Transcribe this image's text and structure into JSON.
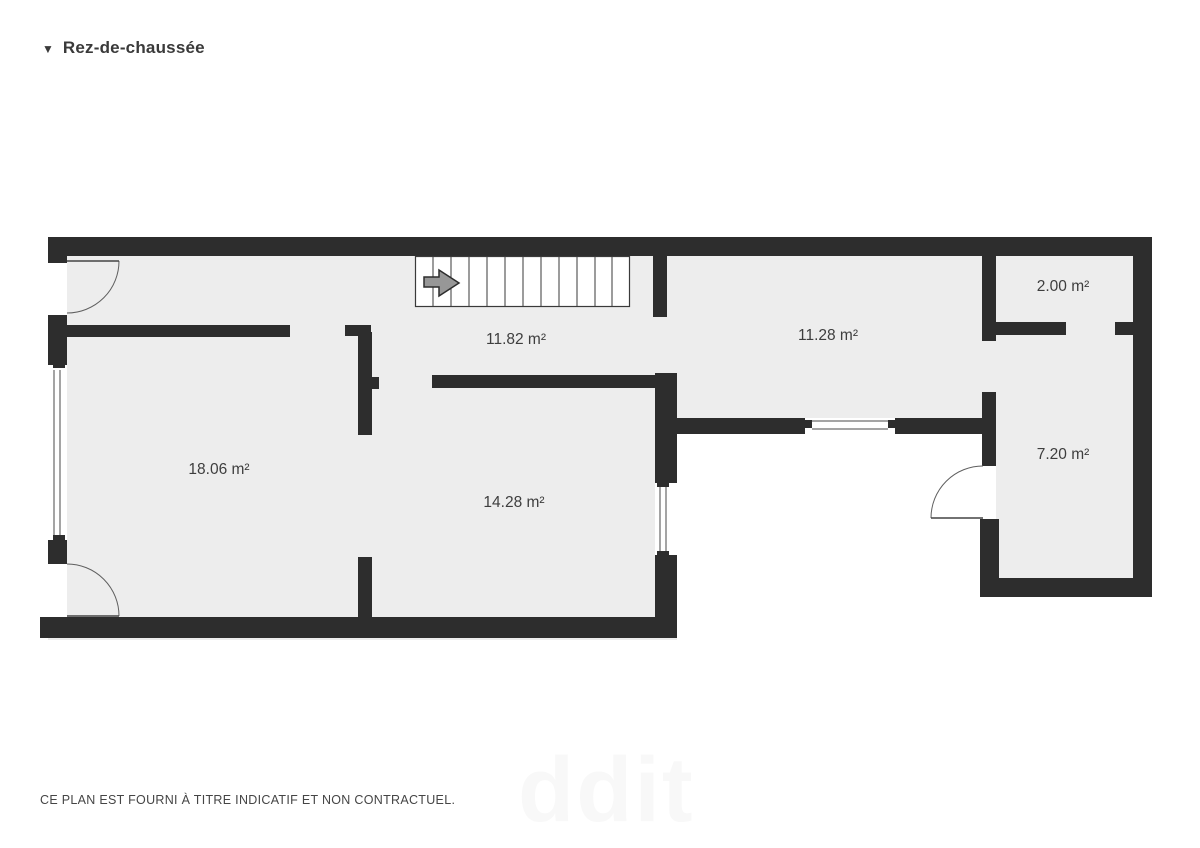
{
  "header": {
    "collapse_icon": "▼",
    "title": "Rez-de-chaussée"
  },
  "footer": {
    "disclaimer": "CE PLAN EST FOURNI À TITRE INDICATIF ET NON CONTRACTUEL.",
    "watermark": "ddit"
  },
  "colors": {
    "wall": "#2d2d2d",
    "floor": "#ededed",
    "window_line": "#4a4a4a",
    "door_line": "#5f5f5f",
    "stair_line": "#3a3a3a",
    "stair_box_fill": "#ffffff",
    "arrow_fill": "#979797",
    "arrow_stroke": "#2d2d2d"
  },
  "floorplan": {
    "floors": [
      {
        "x": 48,
        "y": 237,
        "w": 629,
        "h": 403
      },
      {
        "x": 653,
        "y": 237,
        "w": 346,
        "h": 196
      },
      {
        "x": 982,
        "y": 237,
        "w": 170,
        "h": 360
      }
    ],
    "walls": [
      {
        "x": 48,
        "y": 237,
        "w": 1102,
        "h": 19
      },
      {
        "x": 48,
        "y": 237,
        "w": 19,
        "h": 26
      },
      {
        "x": 48,
        "y": 315,
        "w": 19,
        "h": 50
      },
      {
        "x": 48,
        "y": 540,
        "w": 19,
        "h": 24
      },
      {
        "x": 40,
        "y": 617,
        "w": 637,
        "h": 21
      },
      {
        "x": 67,
        "y": 325,
        "w": 223,
        "h": 12
      },
      {
        "x": 345,
        "y": 325,
        "w": 26,
        "h": 11
      },
      {
        "x": 358,
        "y": 332,
        "w": 14,
        "h": 103
      },
      {
        "x": 370,
        "y": 377,
        "w": 9,
        "h": 12
      },
      {
        "x": 432,
        "y": 375,
        "w": 225,
        "h": 13
      },
      {
        "x": 358,
        "y": 557,
        "w": 14,
        "h": 65
      },
      {
        "x": 653,
        "y": 256,
        "w": 14,
        "h": 61
      },
      {
        "x": 655,
        "y": 373,
        "w": 22,
        "h": 110
      },
      {
        "x": 655,
        "y": 555,
        "w": 22,
        "h": 83
      },
      {
        "x": 672,
        "y": 418,
        "w": 133,
        "h": 16
      },
      {
        "x": 895,
        "y": 418,
        "w": 95,
        "h": 16
      },
      {
        "x": 982,
        "y": 248,
        "w": 14,
        "h": 93
      },
      {
        "x": 982,
        "y": 392,
        "w": 14,
        "h": 74
      },
      {
        "x": 980,
        "y": 519,
        "w": 19,
        "h": 78
      },
      {
        "x": 980,
        "y": 578,
        "w": 172,
        "h": 19
      },
      {
        "x": 1133,
        "y": 237,
        "w": 19,
        "h": 360
      },
      {
        "x": 996,
        "y": 322,
        "w": 70,
        "h": 13
      },
      {
        "x": 1115,
        "y": 322,
        "w": 18,
        "h": 13
      }
    ],
    "door_openings": [
      {
        "x": 48,
        "y": 263,
        "w": 19,
        "h": 52
      },
      {
        "x": 48,
        "y": 564,
        "w": 19,
        "h": 53
      },
      {
        "x": 980,
        "y": 466,
        "w": 16,
        "h": 53
      }
    ],
    "windows": [
      {
        "rect": {
          "x": 48,
          "y": 365,
          "w": 19,
          "h": 175
        },
        "lines": [
          {
            "x1": 54,
            "y1": 370,
            "x2": 54,
            "y2": 535
          },
          {
            "x1": 60,
            "y1": 370,
            "x2": 60,
            "y2": 535
          }
        ],
        "caps": [
          {
            "x": 53,
            "y": 363,
            "w": 12,
            "h": 5
          },
          {
            "x": 53,
            "y": 535,
            "w": 12,
            "h": 5
          }
        ]
      },
      {
        "rect": {
          "x": 655,
          "y": 483,
          "w": 22,
          "h": 72
        },
        "lines": [
          {
            "x1": 660,
            "y1": 485,
            "x2": 660,
            "y2": 553
          },
          {
            "x1": 666,
            "y1": 485,
            "x2": 666,
            "y2": 553
          }
        ],
        "caps": [
          {
            "x": 657,
            "y": 483,
            "w": 12,
            "h": 4
          },
          {
            "x": 657,
            "y": 551,
            "w": 12,
            "h": 4
          }
        ]
      },
      {
        "rect": {
          "x": 805,
          "y": 418,
          "w": 90,
          "h": 16
        },
        "lines": [
          {
            "x1": 812,
            "y1": 421,
            "x2": 888,
            "y2": 421
          },
          {
            "x1": 812,
            "y1": 429,
            "x2": 888,
            "y2": 429
          }
        ],
        "caps": [
          {
            "x": 805,
            "y": 420,
            "w": 7,
            "h": 8
          },
          {
            "x": 888,
            "y": 420,
            "w": 7,
            "h": 8
          }
        ]
      }
    ],
    "doors": [
      {
        "leaf": {
          "x1": 67,
          "y1": 261,
          "x2": 119,
          "y2": 261
        },
        "arc": "M 119 261 A 52 52 0 0 1 67 313"
      },
      {
        "leaf": {
          "x1": 67,
          "y1": 616,
          "x2": 119,
          "y2": 616
        },
        "arc": "M 67 564 A 52 52 0 0 1 119 616"
      },
      {
        "leaf": {
          "x1": 931,
          "y1": 518,
          "x2": 983,
          "y2": 518
        },
        "arc": "M 983 466 A 52 52 0 0 0 931 518"
      }
    ],
    "stairs": {
      "box": {
        "x": 415,
        "y": 256,
        "w": 215,
        "h": 51
      },
      "tread_xs": [
        433,
        451,
        469,
        487,
        505,
        523,
        541,
        559,
        577,
        595,
        612
      ],
      "tread_y1": 257,
      "tread_y2": 306,
      "arrow_points": "424,277 439,277 439,270 459,283 439,296 439,287 424,287"
    },
    "rooms": [
      {
        "label": "18.06 m²",
        "cx": 219,
        "cy": 470
      },
      {
        "label": "14.28 m²",
        "cx": 514,
        "cy": 503
      },
      {
        "label": "11.82 m²",
        "cx": 516,
        "cy": 340
      },
      {
        "label": "11.28 m²",
        "cx": 828,
        "cy": 336
      },
      {
        "label": "2.00 m²",
        "cx": 1063,
        "cy": 287
      },
      {
        "label": "7.20 m²",
        "cx": 1063,
        "cy": 455
      }
    ]
  }
}
